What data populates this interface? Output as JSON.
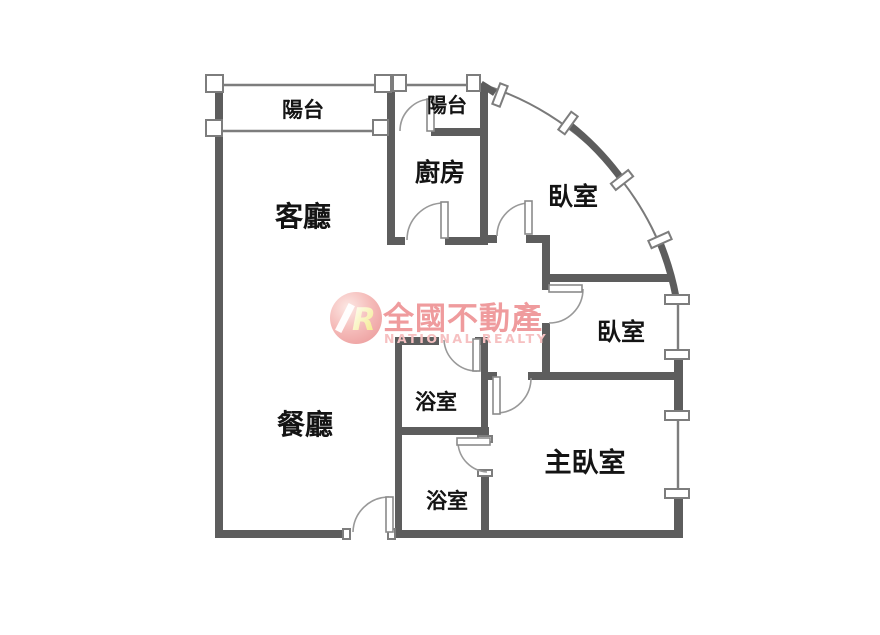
{
  "rooms": {
    "balcony_1": "陽台",
    "balcony_2": "陽台",
    "kitchen": "廚房",
    "bedroom_1": "臥室",
    "living_room": "客廳",
    "bedroom_2": "臥室",
    "bathroom_1": "浴室",
    "dining_room": "餐廳",
    "master_bedroom": "主臥室",
    "bathroom_2": "浴室"
  },
  "watermark": {
    "brand_zh": "全國不動產",
    "brand_en": "NATIONAL REALTY",
    "logo_letter": "R"
  },
  "colors": {
    "wall": "#5d5d5d",
    "thin_line": "#7d7d7d",
    "label_text": "#141414",
    "brand_text_zh": "#ef9b9d",
    "brand_text_en": "#f6c0c1",
    "logo_letter_fill": "#f3e87c",
    "background": "#ffffff"
  }
}
